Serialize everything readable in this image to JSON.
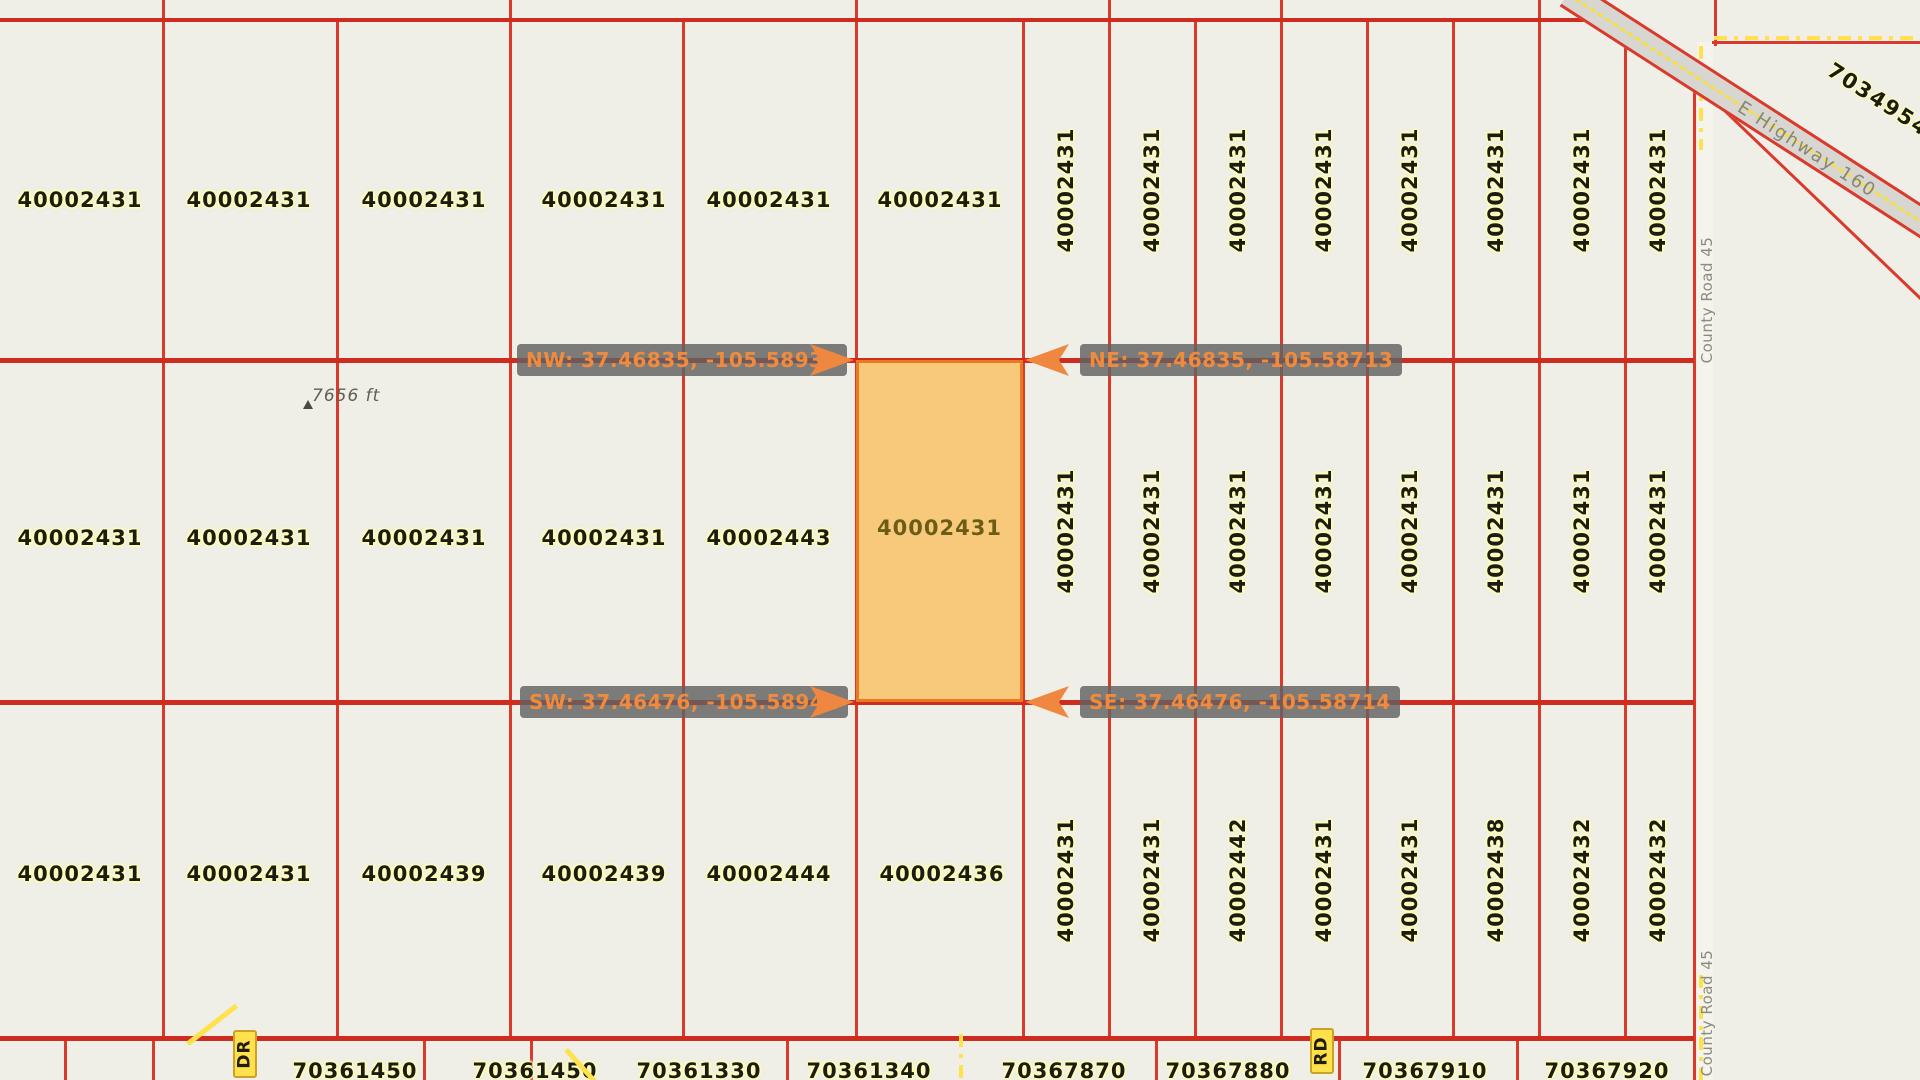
{
  "colors": {
    "background": "#efeee7",
    "parcel_line_red": "#da3a2c",
    "section_line_red": "#cc2d20",
    "highlight_fill": "#f8c97b",
    "highlight_border": "#ea7a1f",
    "marker_text_orange": "#f08b3e",
    "marker_box_gray": "rgba(97,97,97,0.82)",
    "label_halo_yellow": "#ffffb4",
    "road_yellow": "#ffe14b",
    "highway_gray": "#d7d6d1",
    "road_text_gray": "#85857a"
  },
  "corner_markers": {
    "nw": "NW: 37.46835, -105.58938",
    "ne": "NE: 37.46835, -105.58713",
    "sw": "SW: 37.46476, -105.58941",
    "se": "SE: 37.46476, -105.58714"
  },
  "highlighted_parcel": {
    "id": "40002431"
  },
  "elevation_marker": {
    "text": "7656 ft"
  },
  "roads": {
    "highway_name": "E Highway 160",
    "county_road_name": "County Road 45",
    "badge_dr": "DR",
    "badge_rd": "RD"
  },
  "diagonal_parcel_id": "7034954",
  "parcel_labels": [
    {
      "id": "40002431",
      "x": 80,
      "y": 200,
      "o": "h"
    },
    {
      "id": "40002431",
      "x": 249,
      "y": 200,
      "o": "h"
    },
    {
      "id": "40002431",
      "x": 424,
      "y": 200,
      "o": "h"
    },
    {
      "id": "40002431",
      "x": 604,
      "y": 200,
      "o": "h"
    },
    {
      "id": "40002431",
      "x": 769,
      "y": 200,
      "o": "h"
    },
    {
      "id": "40002431",
      "x": 940,
      "y": 200,
      "o": "h"
    },
    {
      "id": "40002431",
      "x": 1066,
      "y": 190,
      "o": "v"
    },
    {
      "id": "40002431",
      "x": 1152,
      "y": 190,
      "o": "v"
    },
    {
      "id": "40002431",
      "x": 1238,
      "y": 190,
      "o": "v"
    },
    {
      "id": "40002431",
      "x": 1324,
      "y": 190,
      "o": "v"
    },
    {
      "id": "40002431",
      "x": 1410,
      "y": 190,
      "o": "v"
    },
    {
      "id": "40002431",
      "x": 1496,
      "y": 190,
      "o": "v"
    },
    {
      "id": "40002431",
      "x": 1582,
      "y": 190,
      "o": "v"
    },
    {
      "id": "40002431",
      "x": 1658,
      "y": 190,
      "o": "v"
    },
    {
      "id": "40002431",
      "x": 80,
      "y": 538,
      "o": "h"
    },
    {
      "id": "40002431",
      "x": 249,
      "y": 538,
      "o": "h"
    },
    {
      "id": "40002431",
      "x": 424,
      "y": 538,
      "o": "h"
    },
    {
      "id": "40002431",
      "x": 604,
      "y": 538,
      "o": "h"
    },
    {
      "id": "40002443",
      "x": 769,
      "y": 538,
      "o": "h"
    },
    {
      "id": "40002431",
      "x": 1066,
      "y": 531,
      "o": "v"
    },
    {
      "id": "40002431",
      "x": 1152,
      "y": 531,
      "o": "v"
    },
    {
      "id": "40002431",
      "x": 1238,
      "y": 531,
      "o": "v"
    },
    {
      "id": "40002431",
      "x": 1324,
      "y": 531,
      "o": "v"
    },
    {
      "id": "40002431",
      "x": 1410,
      "y": 531,
      "o": "v"
    },
    {
      "id": "40002431",
      "x": 1496,
      "y": 531,
      "o": "v"
    },
    {
      "id": "40002431",
      "x": 1582,
      "y": 531,
      "o": "v"
    },
    {
      "id": "40002431",
      "x": 1658,
      "y": 531,
      "o": "v"
    },
    {
      "id": "40002431",
      "x": 80,
      "y": 874,
      "o": "h"
    },
    {
      "id": "40002431",
      "x": 249,
      "y": 874,
      "o": "h"
    },
    {
      "id": "40002439",
      "x": 424,
      "y": 874,
      "o": "h"
    },
    {
      "id": "40002439",
      "x": 604,
      "y": 874,
      "o": "h"
    },
    {
      "id": "40002444",
      "x": 769,
      "y": 874,
      "o": "h"
    },
    {
      "id": "40002436",
      "x": 942,
      "y": 874,
      "o": "h"
    },
    {
      "id": "40002431",
      "x": 1066,
      "y": 880,
      "o": "v"
    },
    {
      "id": "40002431",
      "x": 1152,
      "y": 880,
      "o": "v"
    },
    {
      "id": "40002442",
      "x": 1238,
      "y": 880,
      "o": "v"
    },
    {
      "id": "40002431",
      "x": 1324,
      "y": 880,
      "o": "v"
    },
    {
      "id": "40002431",
      "x": 1410,
      "y": 880,
      "o": "v"
    },
    {
      "id": "40002438",
      "x": 1496,
      "y": 880,
      "o": "v"
    },
    {
      "id": "40002432",
      "x": 1582,
      "y": 880,
      "o": "v"
    },
    {
      "id": "40002432",
      "x": 1658,
      "y": 880,
      "o": "v"
    }
  ],
  "bottom_strip_labels": [
    {
      "id": "70361450",
      "x": 355,
      "y": 1071
    },
    {
      "id": "70361450",
      "x": 535,
      "y": 1071
    },
    {
      "id": "70361330",
      "x": 699,
      "y": 1071
    },
    {
      "id": "70361340",
      "x": 869,
      "y": 1071
    },
    {
      "id": "70367870",
      "x": 1064,
      "y": 1071
    },
    {
      "id": "70367880",
      "x": 1228,
      "y": 1071
    },
    {
      "id": "70367910",
      "x": 1425,
      "y": 1071
    },
    {
      "id": "70367920",
      "x": 1607,
      "y": 1071
    }
  ],
  "grid": {
    "v_lines": [
      {
        "x": 163,
        "y1": 0,
        "y2": 1038
      },
      {
        "x": 337,
        "y1": 20,
        "y2": 1038
      },
      {
        "x": 510,
        "y1": 0,
        "y2": 1038
      },
      {
        "x": 683,
        "y1": 20,
        "y2": 1038
      },
      {
        "x": 856,
        "y1": 0,
        "y2": 1038
      },
      {
        "x": 1023,
        "y1": 20,
        "y2": 1038
      },
      {
        "x": 1109,
        "y1": 0,
        "y2": 1038
      },
      {
        "x": 1195,
        "y1": 20,
        "y2": 1038
      },
      {
        "x": 1281,
        "y1": 0,
        "y2": 1038
      },
      {
        "x": 1367,
        "y1": 20,
        "y2": 1038
      },
      {
        "x": 1453,
        "y1": 20,
        "y2": 1038
      },
      {
        "x": 1539,
        "y1": 0,
        "y2": 1038
      },
      {
        "x": 1625,
        "y1": 20,
        "y2": 1038
      },
      {
        "x": 1694,
        "y1": 60,
        "y2": 1080
      },
      {
        "x": 1715,
        "y1": 0,
        "y2": 46
      },
      {
        "x": 65,
        "y1": 1038,
        "y2": 1080
      },
      {
        "x": 153,
        "y1": 1038,
        "y2": 1080
      },
      {
        "x": 424,
        "y1": 1038,
        "y2": 1080
      },
      {
        "x": 531,
        "y1": 1038,
        "y2": 1080
      },
      {
        "x": 787,
        "y1": 1038,
        "y2": 1080
      },
      {
        "x": 1156,
        "y1": 1038,
        "y2": 1080
      },
      {
        "x": 1339,
        "y1": 1038,
        "y2": 1080
      },
      {
        "x": 1517,
        "y1": 1038,
        "y2": 1080
      }
    ],
    "h_lines": [
      {
        "y": 20,
        "x1": 0,
        "x2": 1612,
        "w": 4,
        "dark": true
      },
      {
        "y": 360,
        "x1": 0,
        "x2": 1694,
        "w": 5,
        "dark": true
      },
      {
        "y": 702,
        "x1": 0,
        "x2": 1694,
        "w": 5,
        "dark": true
      },
      {
        "y": 1038,
        "x1": 0,
        "x2": 1694,
        "w": 5,
        "dark": true
      },
      {
        "y": 42,
        "x1": 1712,
        "x2": 1920,
        "w": 3,
        "dark": false
      }
    ],
    "diag_lines": [
      {
        "x": 1713,
        "y": 98,
        "len": 292,
        "ang": 43.8
      }
    ],
    "yellow_dashes": [
      {
        "type": "v",
        "x": 1701,
        "y1": 46,
        "y2": 150
      },
      {
        "type": "v",
        "x": 1701,
        "y1": 975,
        "y2": 1080
      },
      {
        "type": "v",
        "x": 961,
        "y1": 1034,
        "y2": 1080
      },
      {
        "type": "h",
        "y": 38,
        "x1": 1714,
        "x2": 1920
      }
    ]
  }
}
